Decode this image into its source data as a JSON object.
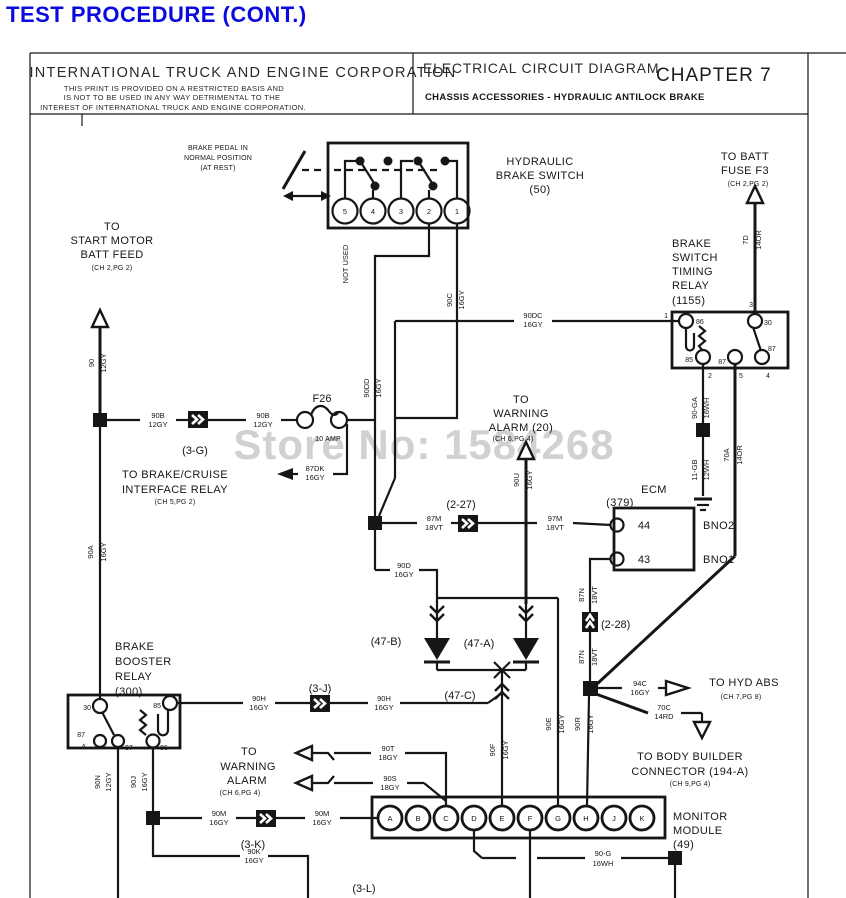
{
  "page_title": "TEST PROCEDURE (CONT.)",
  "title_block": {
    "company": "INTERNATIONAL TRUCK AND ENGINE CORPORATION",
    "restriction_line1": "THIS PRINT IS PROVIDED ON A RESTRICTED BASIS AND",
    "restriction_line2": "IS NOT TO BE USED IN ANY WAY DETRIMENTAL TO THE",
    "restriction_line3": "INTEREST OF INTERNATIONAL TRUCK AND ENGINE CORPORATION.",
    "diagram_type": "ELECTRICAL CIRCUIT DIAGRAM",
    "chapter": "CHAPTER 7",
    "section": "CHASSIS ACCESSORIES - HYDRAULIC ANTILOCK BRAKE"
  },
  "watermark": "Store No: 1584268",
  "labels": {
    "brake_pedal": [
      "BRAKE PEDAL IN",
      "NORMAL POSITION",
      "(AT REST)"
    ],
    "hyd_brake_switch": [
      "HYDRAULIC",
      "BRAKE SWITCH",
      "(50)"
    ],
    "switch_pins": [
      "5",
      "4",
      "3",
      "2",
      "1"
    ],
    "not_used": "NOT USED",
    "to_batt": [
      "TO BATT",
      "FUSE F3",
      "(CH 2,PG 2)"
    ],
    "timing_relay": [
      "BRAKE",
      "SWITCH",
      "TIMING",
      "RELAY",
      "(1155)"
    ],
    "timing_terms": {
      "t86": "86",
      "t30": "30",
      "t85": "85",
      "t87c": "87",
      "t87r": "87",
      "p1": "1",
      "p2": "2",
      "p3": "3",
      "p5": "5",
      "p4": "4"
    },
    "start_motor": [
      "TO",
      "START MOTOR",
      "BATT FEED",
      "(CH 2,PG 2)"
    ],
    "warn_alarm_20": [
      "TO",
      "WARNING",
      "ALARM (20)",
      "(CH 6,PG 4)"
    ],
    "brake_cruise": [
      "TO BRAKE/CRUISE",
      "INTERFACE RELAY",
      "(CH 5,PG 2)"
    ],
    "fuse": [
      "F26",
      "10 AMP"
    ],
    "conn_3g": "(3-G)",
    "conn_227": "(2-27)",
    "conn_228": "(2-28)",
    "conn_3j": "(3-J)",
    "conn_3k": "(3-K)",
    "conn_3l": "(3-L)",
    "ecm": [
      "ECM",
      "(379)"
    ],
    "ecm_pins": {
      "p44": "44",
      "p43": "43",
      "bno2": "BNO2",
      "bno1": "BNO1"
    },
    "d47a": "(47-A)",
    "d47b": "(47-B)",
    "d47c": "(47-C)",
    "to_hyd_abs": [
      "TO HYD ABS",
      "(CH 7,PG 8)"
    ],
    "body_builder": [
      "TO BODY BUILDER",
      "CONNECTOR (194-A)",
      "(CH 9,PG 4)"
    ],
    "booster_relay": [
      "BRAKE",
      "BOOSTER",
      "RELAY",
      "(300)"
    ],
    "booster_terms": {
      "t30": "30",
      "t85": "85",
      "t87": "87",
      "tA": "A",
      "t87b": "87",
      "t86": "86"
    },
    "warn_alarm_2": [
      "TO",
      "WARNING",
      "ALARM",
      "(CH 6,PG 4)"
    ],
    "monitor_module": [
      "MONITOR",
      "MODULE",
      "(49)"
    ],
    "module_pins": [
      "A",
      "B",
      "C",
      "D",
      "E",
      "F",
      "G",
      "H",
      "J",
      "K"
    ]
  },
  "wires": {
    "w7d": [
      "7D",
      "14OR"
    ],
    "w90": [
      "90",
      "12GY"
    ],
    "w90dc": [
      "90DC",
      "16GY"
    ],
    "w90c": [
      "90C",
      "16GY"
    ],
    "w90dd": [
      "90DD",
      "16GY"
    ],
    "w90b1": [
      "90B",
      "12GY"
    ],
    "w90b2": [
      "90B",
      "12GY"
    ],
    "w87dk": [
      "87DK",
      "16GY"
    ],
    "w90u": [
      "90U",
      "16GY"
    ],
    "w90a": [
      "90A",
      "16GY"
    ],
    "w87m": [
      "87M",
      "18VT"
    ],
    "w97m": [
      "97M",
      "18VT"
    ],
    "w87n1": [
      "87N",
      "18VT"
    ],
    "w87n2": [
      "87N",
      "18VT"
    ],
    "w90d": [
      "90D",
      "16GY"
    ],
    "w90h1": [
      "90H",
      "16GY"
    ],
    "w90h2": [
      "90H",
      "16GY"
    ],
    "w70a": [
      "70A",
      "14OR"
    ],
    "w90ga": [
      "90-GA",
      "16WH"
    ],
    "w11gb": [
      "11-GB",
      "12WH"
    ],
    "w94c": [
      "94C",
      "16GY"
    ],
    "w70c": [
      "70C",
      "14RD"
    ],
    "w90r": [
      "90R",
      "16GY"
    ],
    "w90e": [
      "90E",
      "16GY"
    ],
    "w90f": [
      "90F",
      "16GY"
    ],
    "w90t": [
      "90T",
      "18GY"
    ],
    "w90s": [
      "90S",
      "18GY"
    ],
    "w90n": [
      "90N",
      "12GY"
    ],
    "w90j": [
      "90J",
      "16GY"
    ],
    "w90m1": [
      "90M",
      "16GY"
    ],
    "w90m2": [
      "90M",
      "16GY"
    ],
    "w90k": [
      "90K",
      "16GY"
    ],
    "w90g": [
      "90-G",
      "16WH"
    ]
  }
}
